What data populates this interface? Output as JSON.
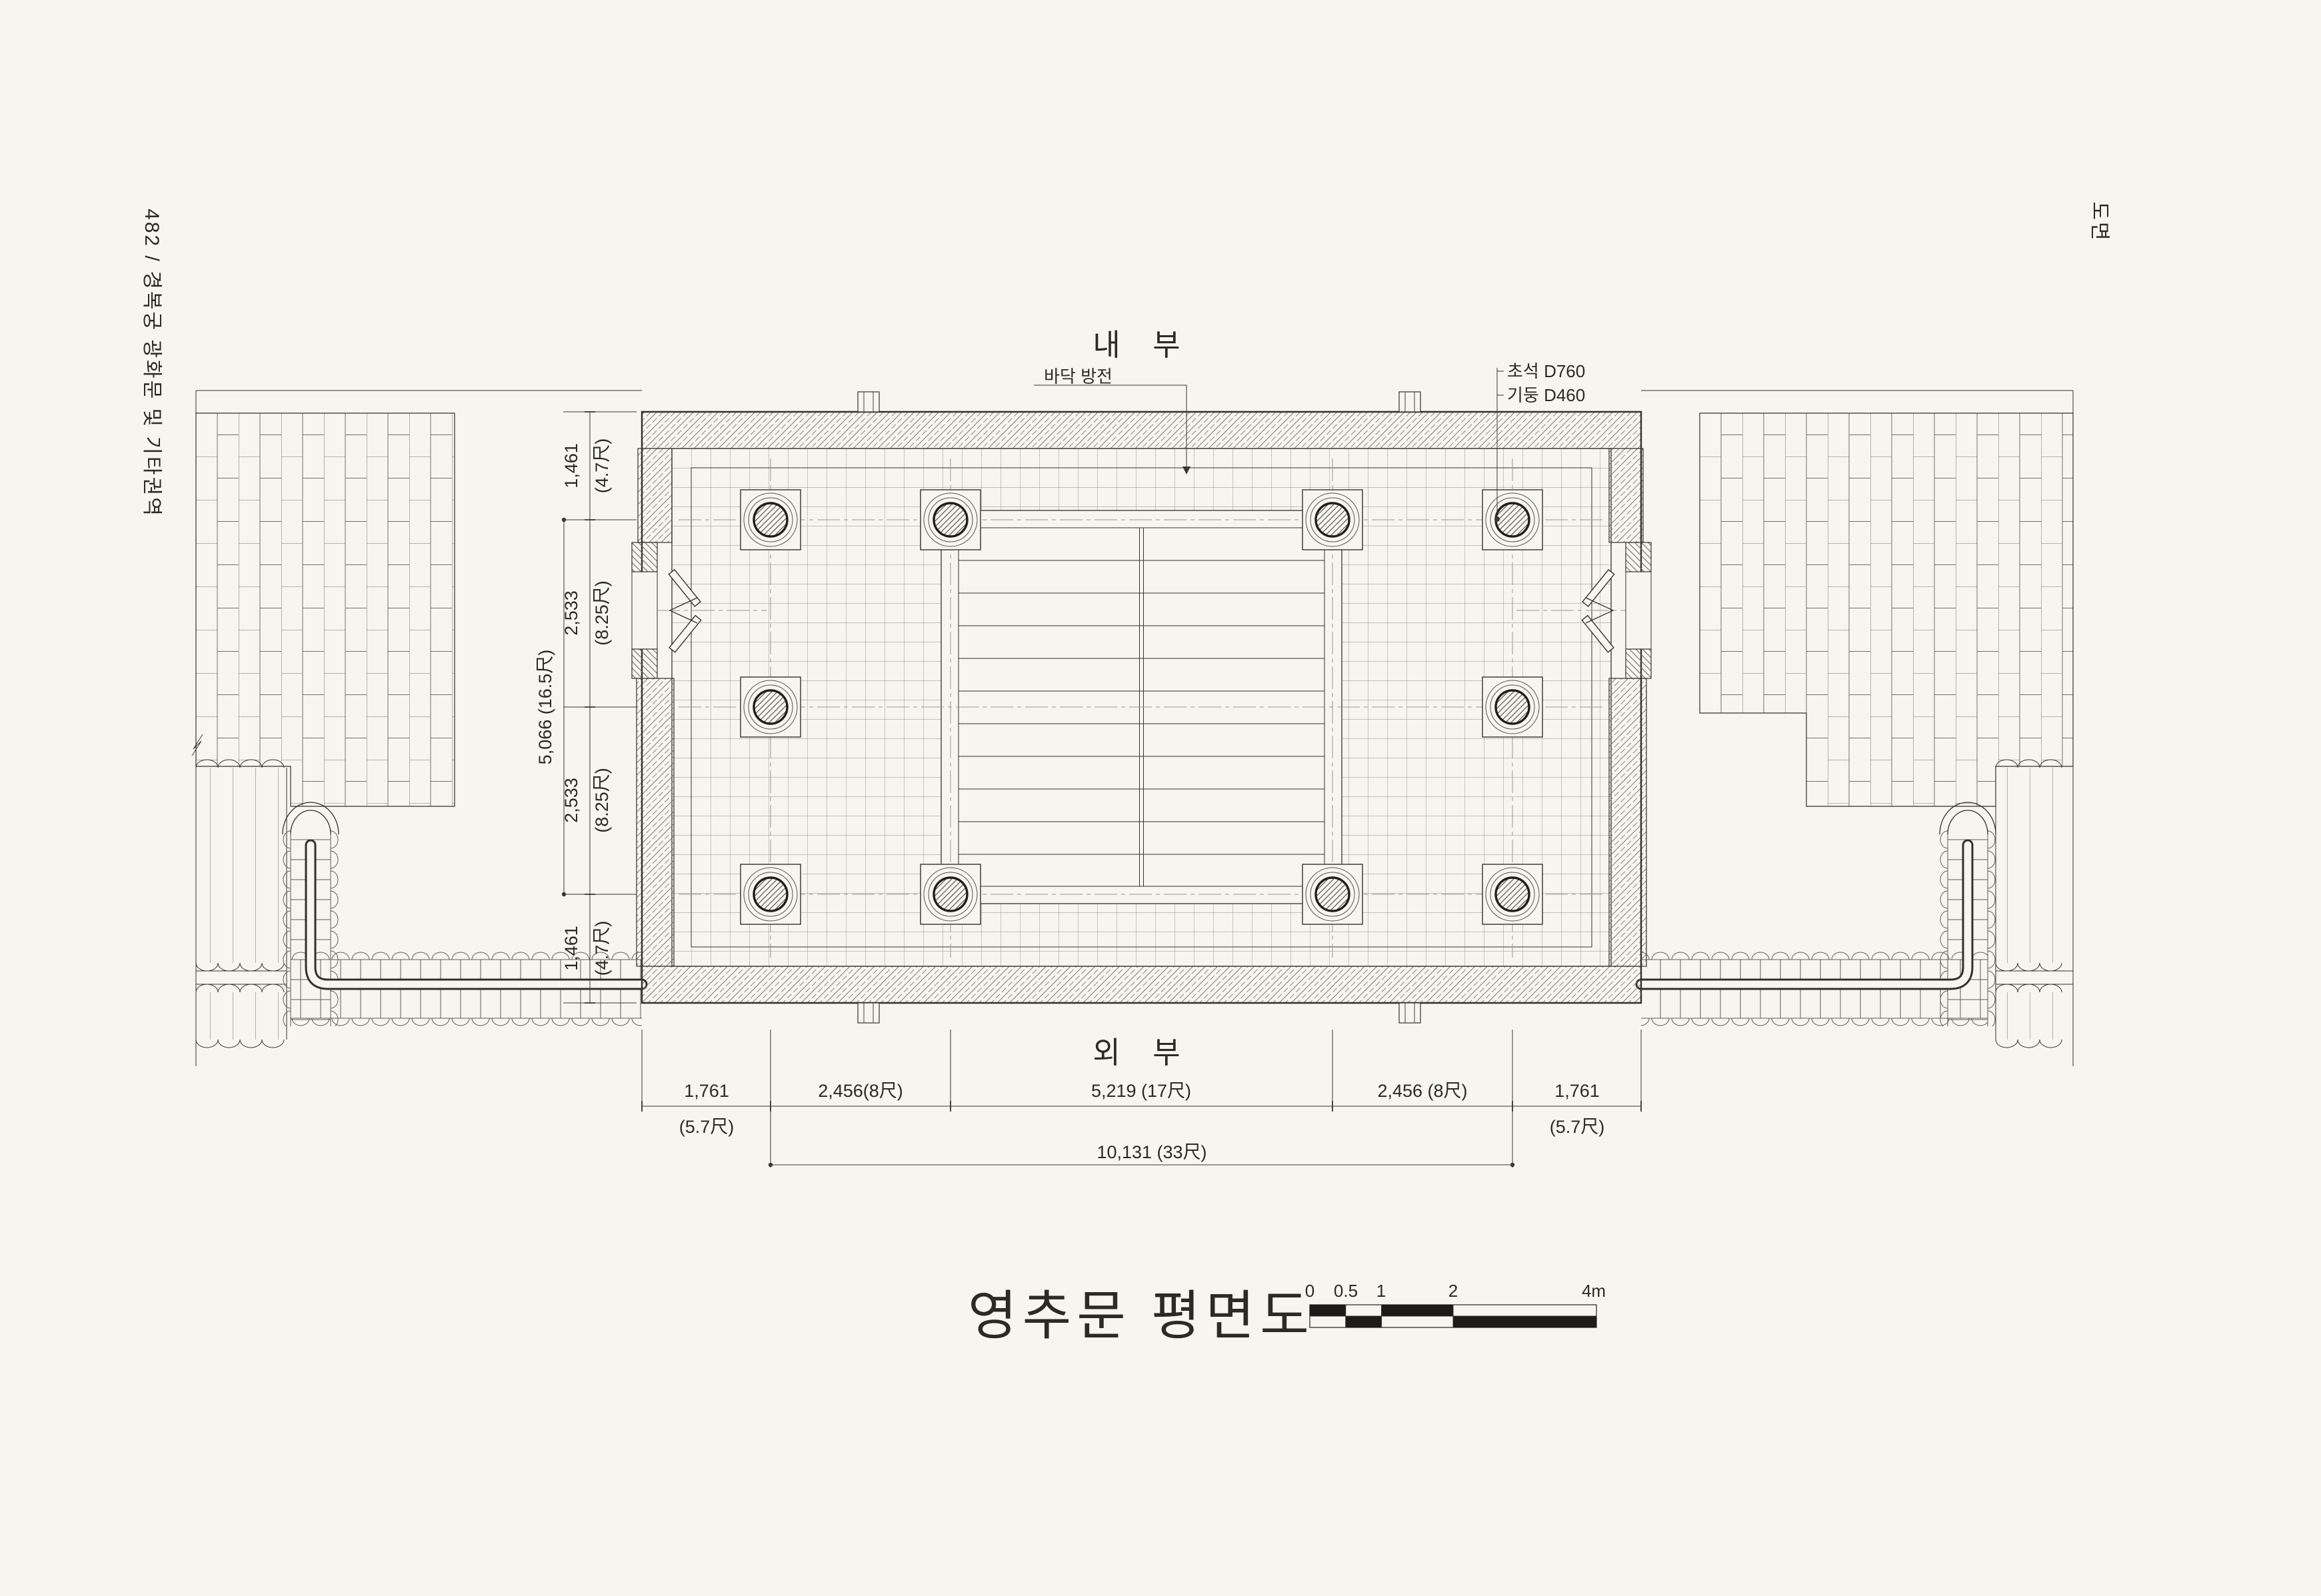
{
  "page": {
    "header": "482 / 경복궁 광화문 및 기타권역",
    "corner": "도면"
  },
  "plan": {
    "interior": "내 부",
    "exterior": "외 부",
    "floor_note": "바닥 방전",
    "foundation_note": "초석 D760",
    "column_note": "기둥 D460",
    "dims_bottom": [
      {
        "v": "1,761",
        "u": "(5.7尺)"
      },
      {
        "v": "2,456(8尺)",
        "u": ""
      },
      {
        "v": "5,219 (17尺)",
        "u": ""
      },
      {
        "v": "2,456 (8尺)",
        "u": ""
      },
      {
        "v": "1,761",
        "u": "(5.7尺)"
      }
    ],
    "dims_bottom_total": "10,131 (33尺)",
    "dims_left": [
      {
        "v": "1,461",
        "u": "(4.7尺)"
      },
      {
        "v": "2,533",
        "u": "(8.25尺)"
      },
      {
        "v": "2,533",
        "u": "(8.25尺)"
      },
      {
        "v": "1,461",
        "u": "(4.7尺)"
      }
    ],
    "dims_left_total": "5,066 (16.5尺)"
  },
  "title_block": {
    "title": "영추문 평면도",
    "scale_labels": [
      "0",
      "0.5",
      "1",
      "2",
      "4m"
    ]
  }
}
